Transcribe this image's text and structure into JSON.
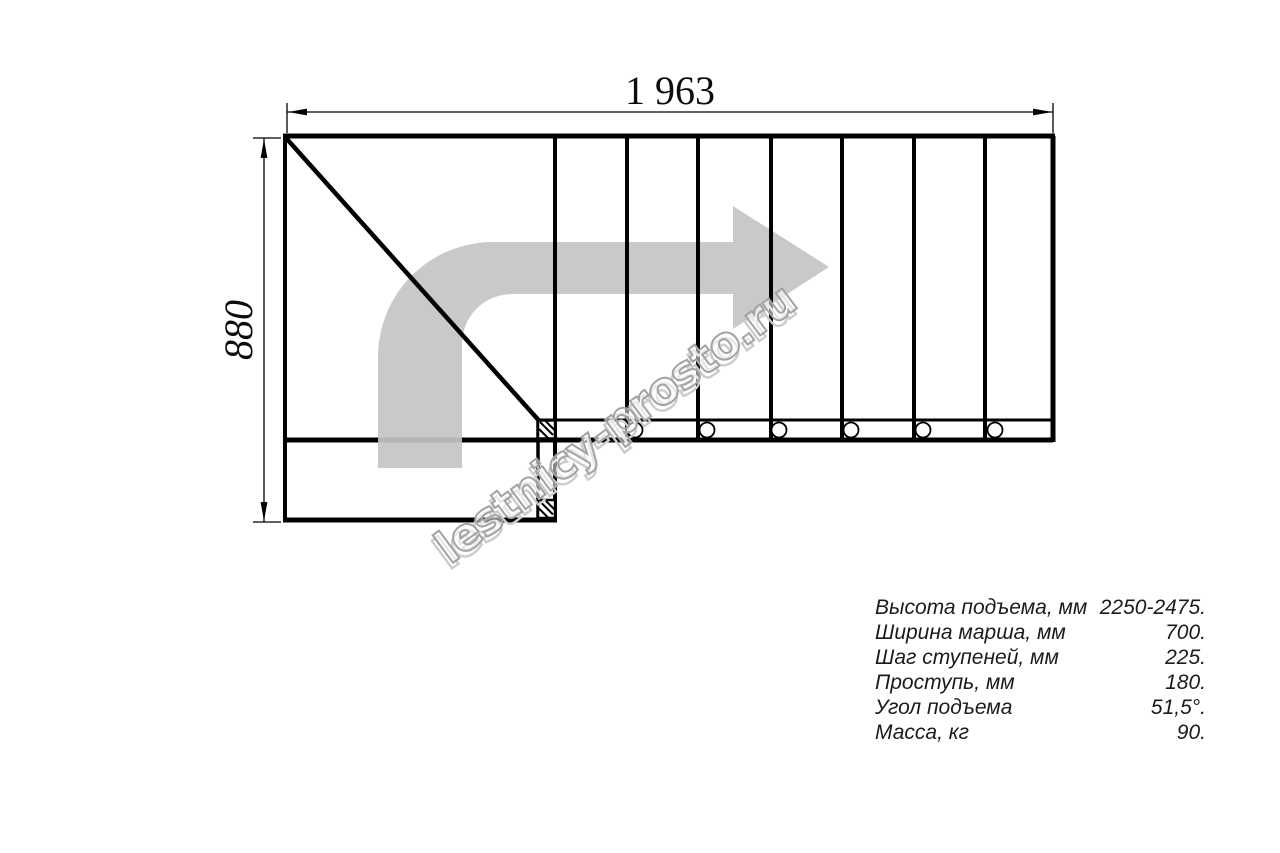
{
  "drawing": {
    "title": "staircase-plan-top-view",
    "width_dim": "1 963",
    "height_dim": "880",
    "watermark": "lestnicy-prosto.ru",
    "step_count_shown": 7,
    "baluster_count_shown": 6
  },
  "colors": {
    "line": "#000000",
    "dimension_text": "#0c0c0c",
    "direction_arrow": "#c4c4c4",
    "watermark_outline": "#a3a3a3",
    "spec_text": "#1b1b1b",
    "background": "#ffffff"
  },
  "specs": {
    "rows": [
      {
        "label": "Высота подъема, мм",
        "value": "2250-2475."
      },
      {
        "label": "Ширина марша, мм",
        "value": "700."
      },
      {
        "label": "Шаг ступеней, мм",
        "value": "225."
      },
      {
        "label": "Проступь, мм",
        "value": "180."
      },
      {
        "label": "Угол подъема",
        "value": "51,5°."
      },
      {
        "label": "Масса, кг",
        "value": "90."
      }
    ]
  }
}
